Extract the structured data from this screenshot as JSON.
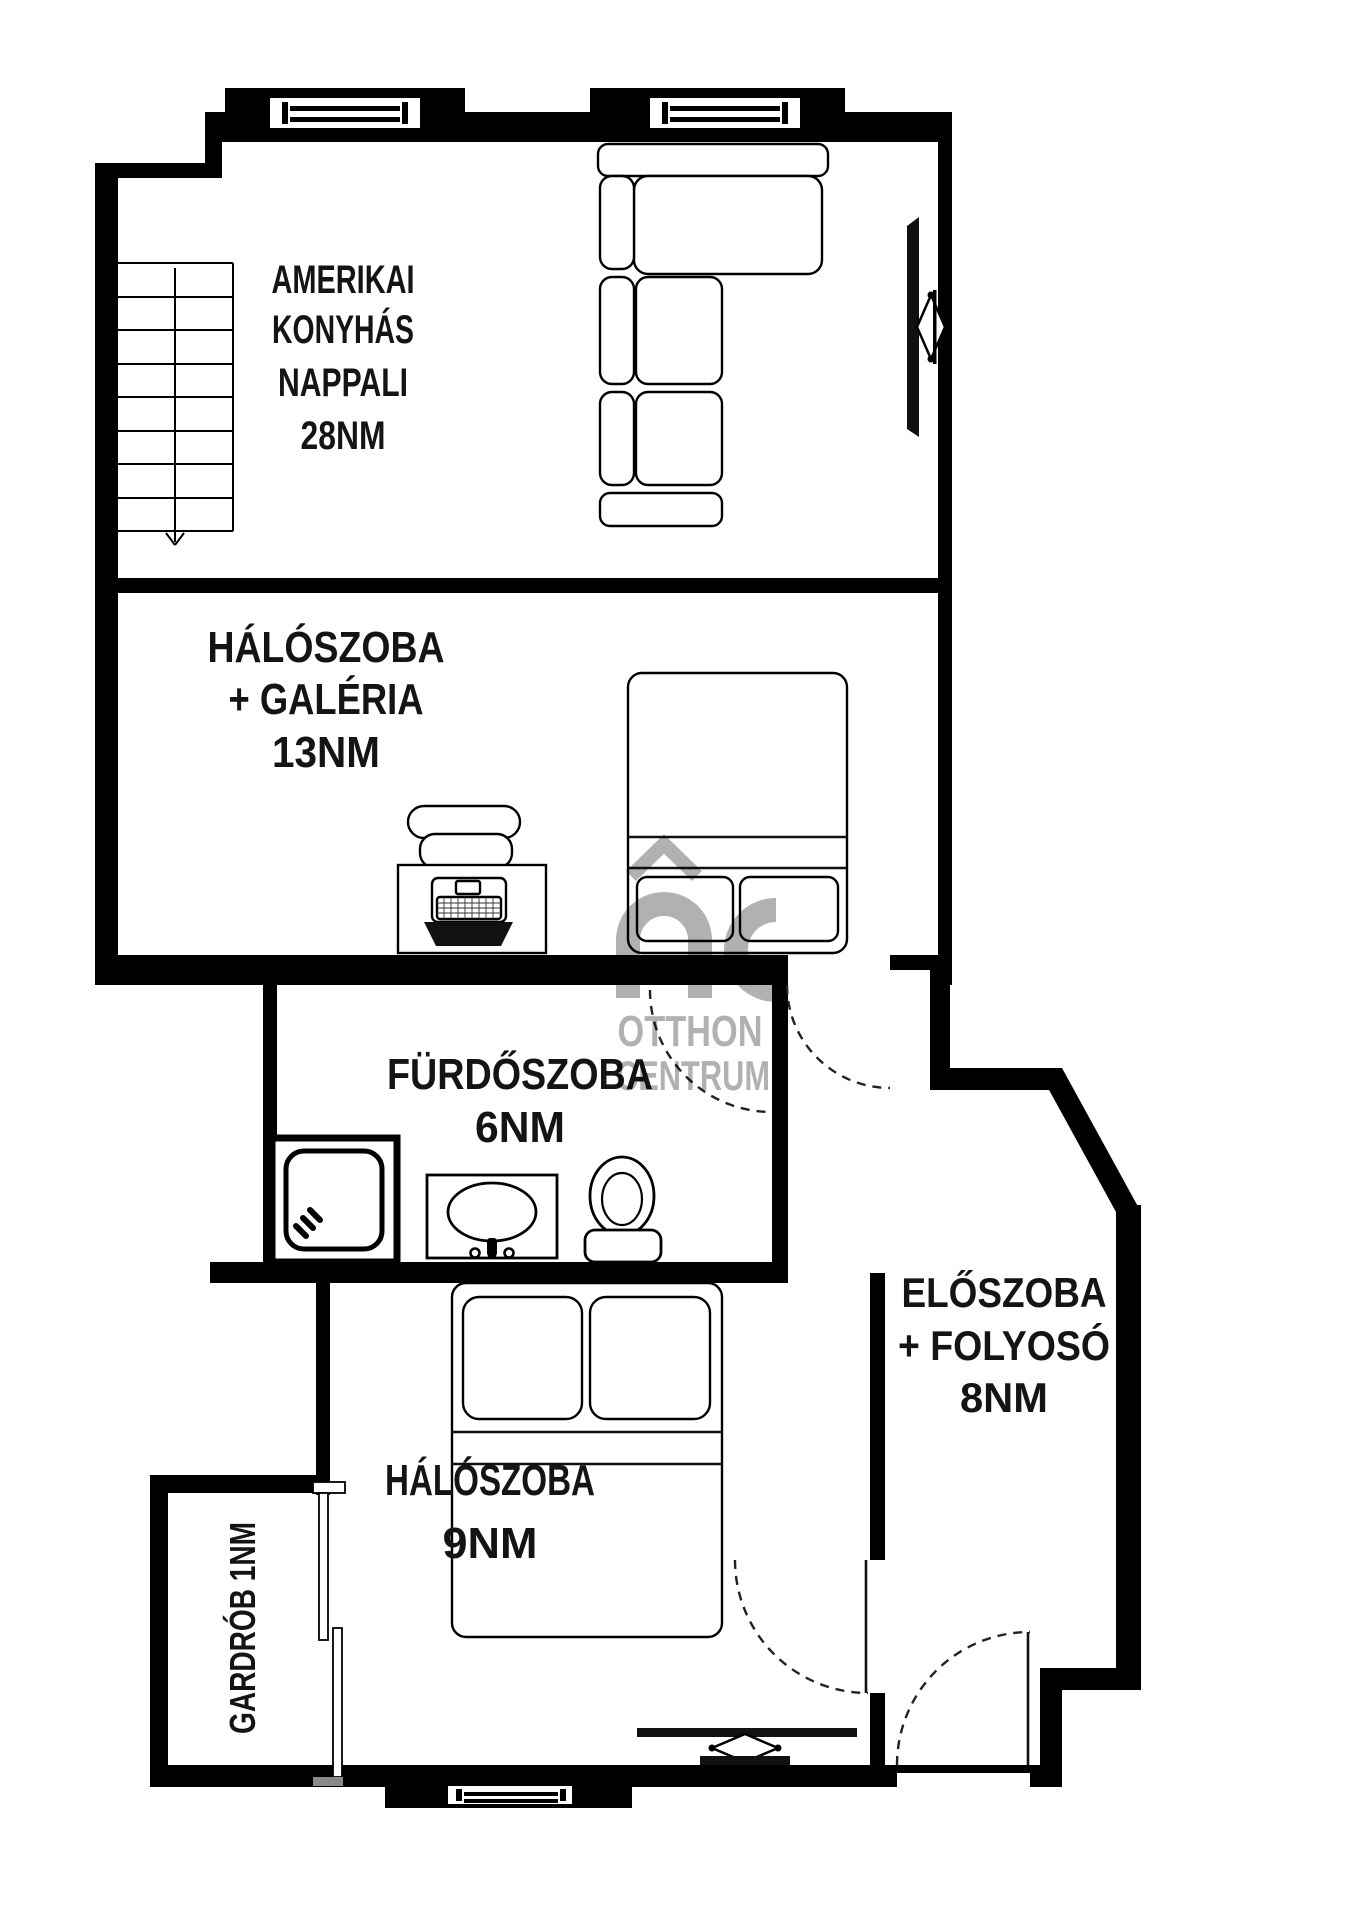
{
  "page": {
    "title": "Apartment floor plan"
  },
  "rooms": {
    "living": {
      "lines": [
        "AMERIKAI",
        "KONYHÁS",
        "NAPPALI",
        "28NM"
      ]
    },
    "bedroom_gallery": {
      "lines": [
        "HÁLÓSZOBA",
        "+ GALÉRIA",
        "13NM"
      ]
    },
    "bathroom": {
      "lines": [
        "FÜRDŐSZOBA",
        "6NM"
      ]
    },
    "hallway": {
      "lines": [
        "ELŐSZOBA",
        "+ FOLYOSÓ",
        "8NM"
      ]
    },
    "bedroom_small": {
      "lines": [
        "HÁLÓSZOBA",
        "9NM"
      ]
    },
    "wardrobe": {
      "lines": [
        "GARDRÓB 1NM"
      ]
    }
  },
  "watermark": {
    "name_line1": "OTTHON",
    "name_line2": "CENTRUM"
  },
  "colors": {
    "background": "#ffffff",
    "walls": "#000000",
    "label_text": "#141414",
    "watermark_gray": "#bdbdbd"
  }
}
